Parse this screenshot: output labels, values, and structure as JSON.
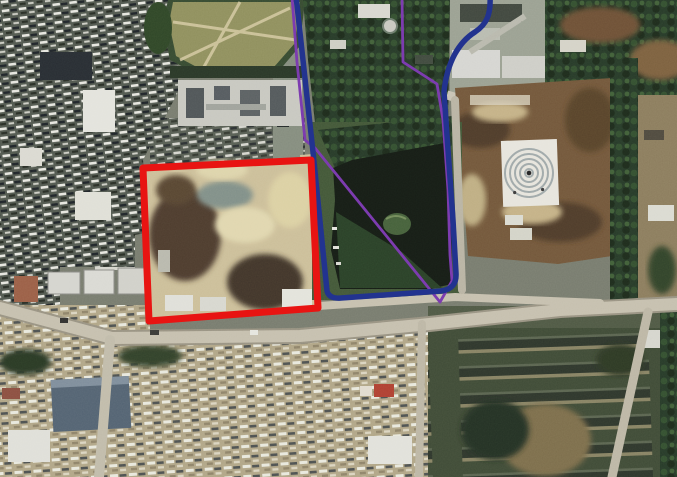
{
  "figure": {
    "kind": "aerial-satellite-photo-with-route-overlays",
    "description": "Urban satellite image: dense housing upper-left, sports field top-center, dark pond with island at center, excavation site outlined in red, brown cleared site with circular white structure at right, main road across middle, campus building rows lower-right."
  },
  "scene": {
    "palette": {
      "base": "#75796a",
      "housing": "#4c5349",
      "town": "#b1a584",
      "trees": "#1f3320",
      "water": "#0e150d",
      "water2": "#223a1f",
      "field": "#8e8e58",
      "dirt": "#6f5233",
      "sand": "#cdbf97",
      "road": "#c7c0ad",
      "campus": "#39452f"
    },
    "landmarks": [
      "dense-housing-blocks",
      "sports-field",
      "tree-park",
      "pond",
      "pond-island",
      "excavation-site",
      "cleared-brown-site",
      "circular-white-structure",
      "main-road",
      "campus-building-rows"
    ]
  },
  "annotations": {
    "red_boundary": {
      "name": "site-boundary-rectangle",
      "color": "#e81412",
      "stroke_width": 7,
      "path": "M143,168 L311,160 L318,308 L149,321 Z"
    },
    "blue_route": {
      "name": "primary-route-around-pond",
      "color": "#22338f",
      "stroke_width": 5.5,
      "path": "M296,-4 L313,152 L327,291 Q329,299 341,298 L441,291 Q457,289 456,273 L453,220 L448,150 L444,92 C447,62 459,42 475,32 C487,24 491,14 490,-4"
    },
    "purple_route": {
      "name": "secondary-route-across-pond",
      "color": "#7d3cb0",
      "stroke_width": 2.8,
      "path": "M402,-3 L403,62 L437,84 L443,120 L448,190 L450,255 L452,281 L440,302 L315,148 L305,140 L297,62 L292,-3"
    }
  }
}
